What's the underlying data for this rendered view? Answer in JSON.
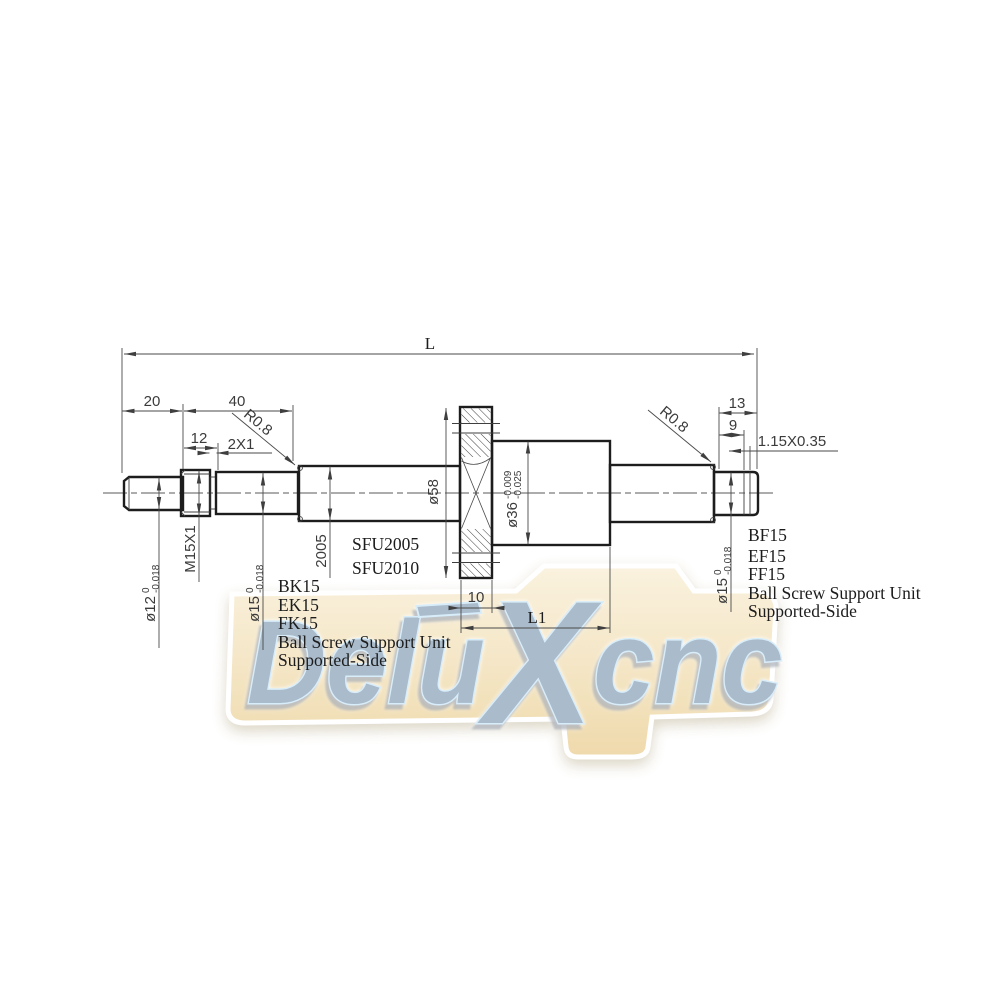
{
  "dims": {
    "overall_length": "L",
    "left_end": "20",
    "left_section": "40",
    "thread_length": "12",
    "undercut": "2X1",
    "fillet_radius_left": "R0.8",
    "fillet_radius_right": "R0.8",
    "right_end": "13",
    "right_journal": "9",
    "circlip_groove": "1.15X0.35",
    "flange_width": "10",
    "nut_length": "L1"
  },
  "labels": {
    "left_journal_dia": {
      "main": "ø12",
      "sup": "0",
      "sub": "-0.018"
    },
    "thread_spec": "M15X1",
    "left_bearing_dia": {
      "main": "ø15",
      "sup": "0",
      "sub": "-0.018"
    },
    "screw_spec": "2005",
    "flange_dia": "ø58",
    "nut_dia": {
      "main": "ø36",
      "sup": "-0.009",
      "sub": "-0.025"
    },
    "right_bearing_dia": {
      "main": "ø15",
      "sup": "0",
      "sub": "-0.018"
    }
  },
  "screw_models": [
    "SFU2005",
    "SFU2010"
  ],
  "left_support": {
    "models": [
      "BK15",
      "EK15",
      "FK15"
    ],
    "line1": "Ball Screw Support Unit",
    "line2": "Supported-Side"
  },
  "right_support": {
    "models": [
      "BF15",
      "EF15",
      "FF15"
    ],
    "line1": "Ball Screw Support Unit",
    "line2": "Supported-Side"
  },
  "watermark": {
    "pre": "Delu",
    "x": "X",
    "post": "cnc"
  },
  "colors": {
    "outline": "#1d1d1d",
    "dim_line": "#4a4a4a",
    "dim_text": "#3b3b3b",
    "note_text": "#1c1c1c",
    "banner_light": "#faf1dd",
    "banner_dark": "#eed7a6",
    "letter_fill": "#a4b6c8",
    "letter_outline": "#d6ecfa"
  }
}
